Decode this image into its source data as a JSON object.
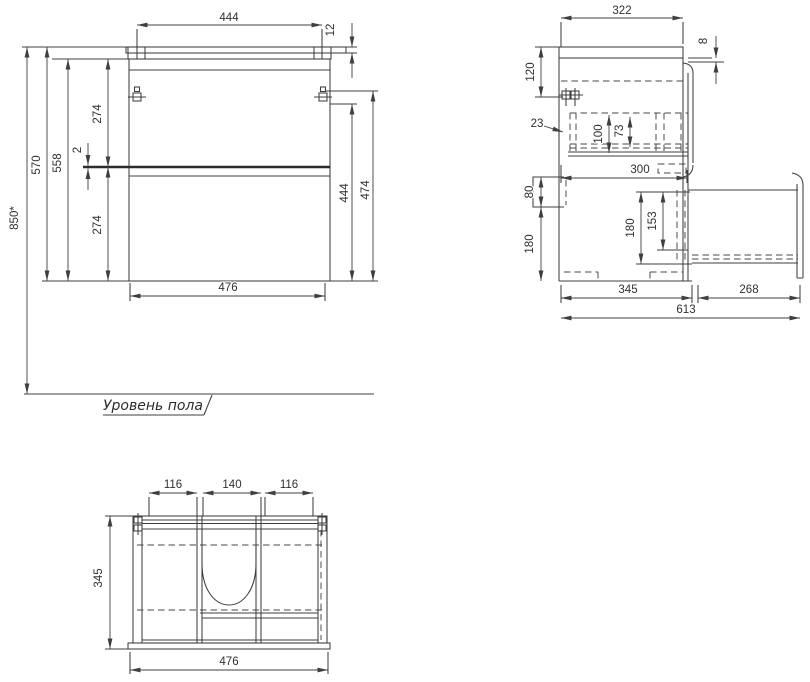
{
  "drawing": {
    "floor_label": "Уровень пола",
    "colors": {
      "line": "#3f3f3f",
      "text": "#303030",
      "background": "#ffffff"
    },
    "views": {
      "front": {
        "width_top": "444",
        "countertop_thickness": "12",
        "height_total": "850*",
        "height_570": "570",
        "height_558": "558",
        "upper_section_274": "274",
        "gap_2": "2",
        "lower_section_274": "274",
        "right_444": "444",
        "right_474": "474",
        "width_bottom": "476"
      },
      "side": {
        "depth_top_322": "322",
        "gap_8": "8",
        "offset_120": "120",
        "offset_23": "23",
        "inner_100": "100",
        "inner_73": "73",
        "depth_300": "300",
        "bracket_80": "80",
        "bracket_180": "180",
        "drawer_180": "180",
        "drawer_153": "153",
        "depth_345": "345",
        "extension_268": "268",
        "total_613": "613"
      },
      "bottom": {
        "left_116": "116",
        "center_140": "140",
        "right_116": "116",
        "depth_345": "345",
        "width_476": "476"
      }
    }
  }
}
